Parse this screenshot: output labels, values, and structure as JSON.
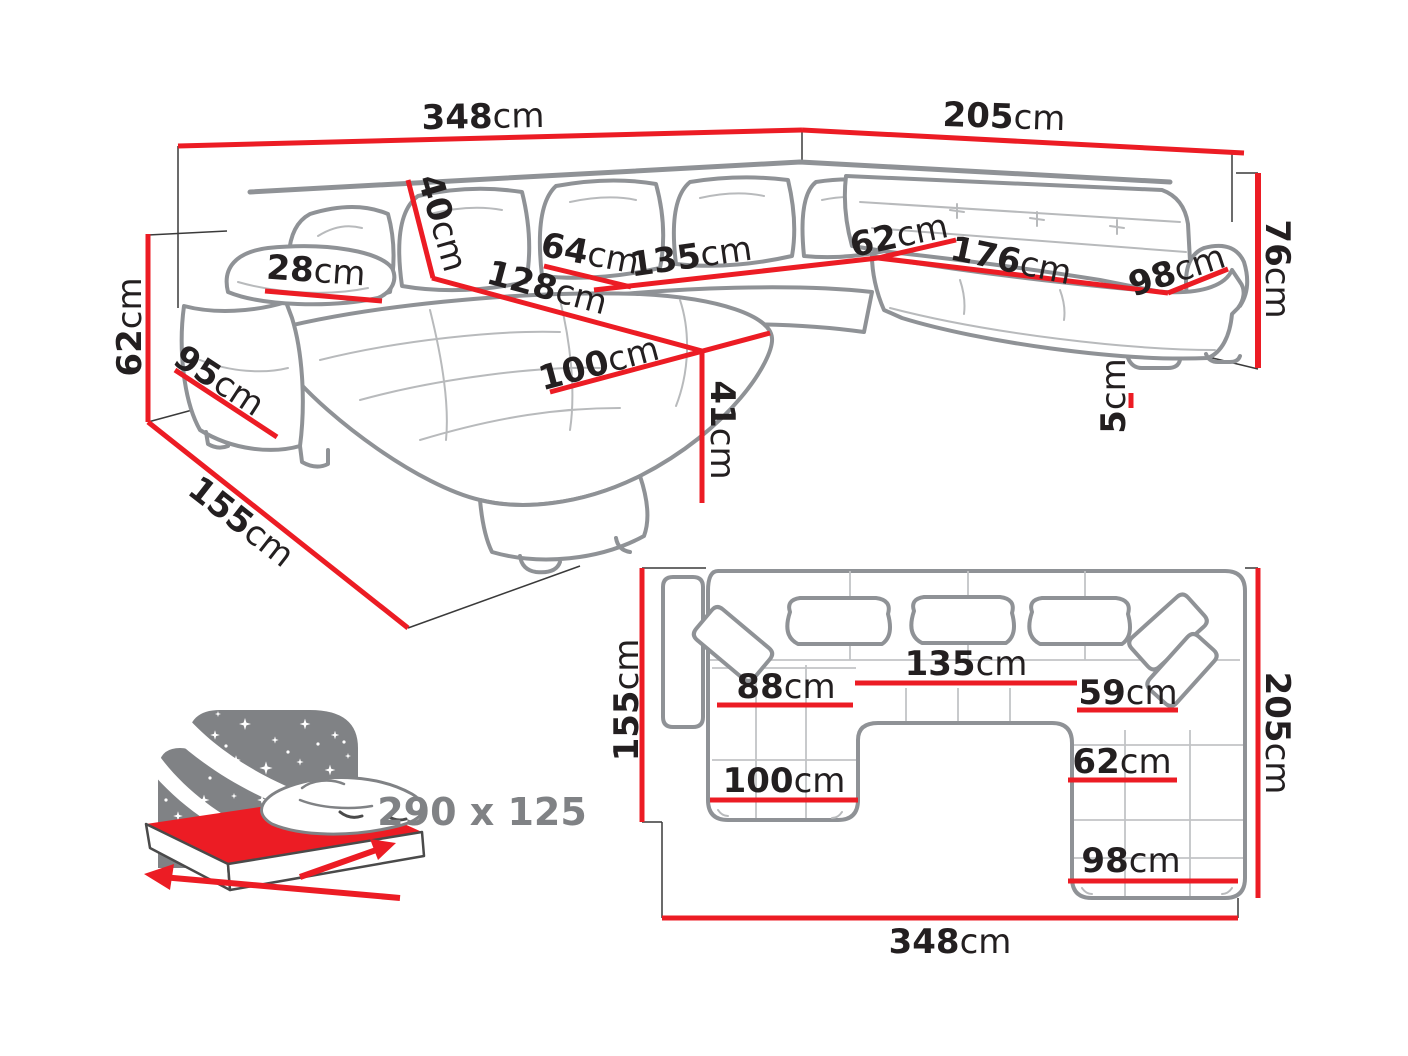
{
  "colors": {
    "dimension_red": "#ec1c24",
    "sofa_outline_gray": "#8f9296",
    "icon_gray": "#808285",
    "label_black": "#231f20"
  },
  "perspective": {
    "back_width": {
      "num": "348",
      "unit": "cm"
    },
    "right_width": {
      "num": "205",
      "unit": "cm"
    },
    "total_height": {
      "num": "76",
      "unit": "cm"
    },
    "left_height": {
      "num": "62",
      "unit": "cm"
    },
    "arm_front": {
      "num": "95",
      "unit": "cm"
    },
    "chaise_length": {
      "num": "155",
      "unit": "cm"
    },
    "arm_width": {
      "num": "28",
      "unit": "cm"
    },
    "back_cushion": {
      "num": "40",
      "unit": "cm"
    },
    "seat_depth": {
      "num": "64",
      "unit": "cm"
    },
    "middle_seat": {
      "num": "135",
      "unit": "cm"
    },
    "chaise_back": {
      "num": "128",
      "unit": "cm"
    },
    "chaise_width": {
      "num": "100",
      "unit": "cm"
    },
    "seat_height": {
      "num": "41",
      "unit": "cm"
    },
    "corner_seat": {
      "num": "62",
      "unit": "cm"
    },
    "right_seat": {
      "num": "176",
      "unit": "cm"
    },
    "end_seat": {
      "num": "98",
      "unit": "cm"
    },
    "leg_height": {
      "num": "5",
      "unit": "cm"
    }
  },
  "plan": {
    "chaise_depth": {
      "num": "155",
      "unit": "cm"
    },
    "left_seat": {
      "num": "88",
      "unit": "cm"
    },
    "middle_seat": {
      "num": "135",
      "unit": "cm"
    },
    "right_seat": {
      "num": "59",
      "unit": "cm"
    },
    "right_inner": {
      "num": "62",
      "unit": "cm"
    },
    "chaise_width": {
      "num": "100",
      "unit": "cm"
    },
    "end_seat": {
      "num": "98",
      "unit": "cm"
    },
    "right_depth": {
      "num": "205",
      "unit": "cm"
    },
    "total_width": {
      "num": "348",
      "unit": "cm"
    }
  },
  "sleeping_area": {
    "label": "290 x 125"
  }
}
